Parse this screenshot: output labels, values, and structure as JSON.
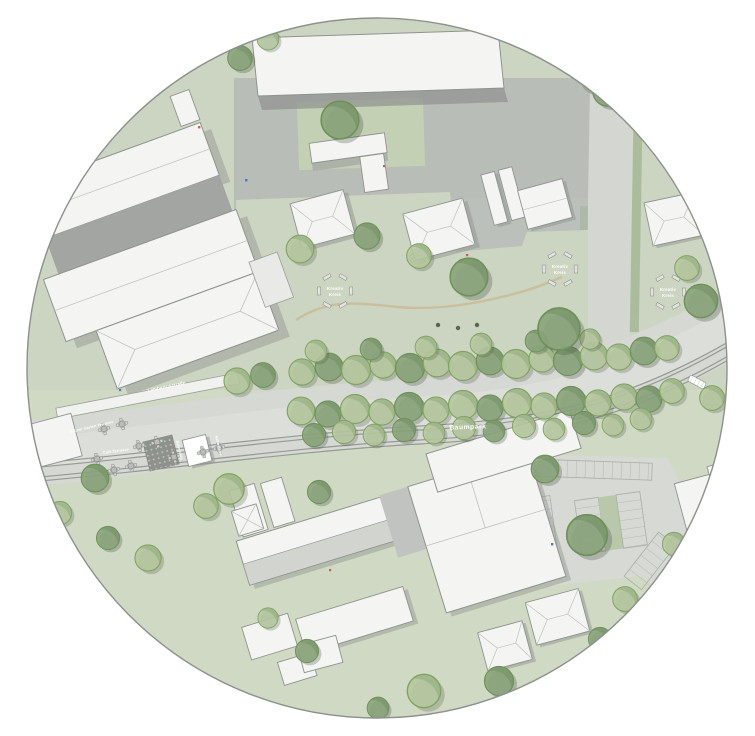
{
  "labels": {
    "street": "Lambertusstraße",
    "terrace": "Grüner Garten Terrasse",
    "cafe": "Café Terrasse",
    "avenue": "Baumpark",
    "platform_a": "Bahnsteig",
    "platform_b": "Haltestelle",
    "circle_line1": "Kreativ",
    "circle_line2": "Kreis"
  },
  "colors": {
    "grass": "#ccd5c1",
    "grass_light": "#d3dcc6",
    "paving": "#b9bdb7",
    "courtyard": "#a2a5a1",
    "road": "#d6d8d3",
    "building": "#f4f5f3",
    "building_shadow": "#90938f",
    "tree_light": "#b5c79e",
    "tree_dark": "#8aa47b",
    "tree_border": "#7fa35f",
    "rail": "#8e948c",
    "path_tan": "#c9ba97",
    "parking_green": "#b9c8ab"
  }
}
